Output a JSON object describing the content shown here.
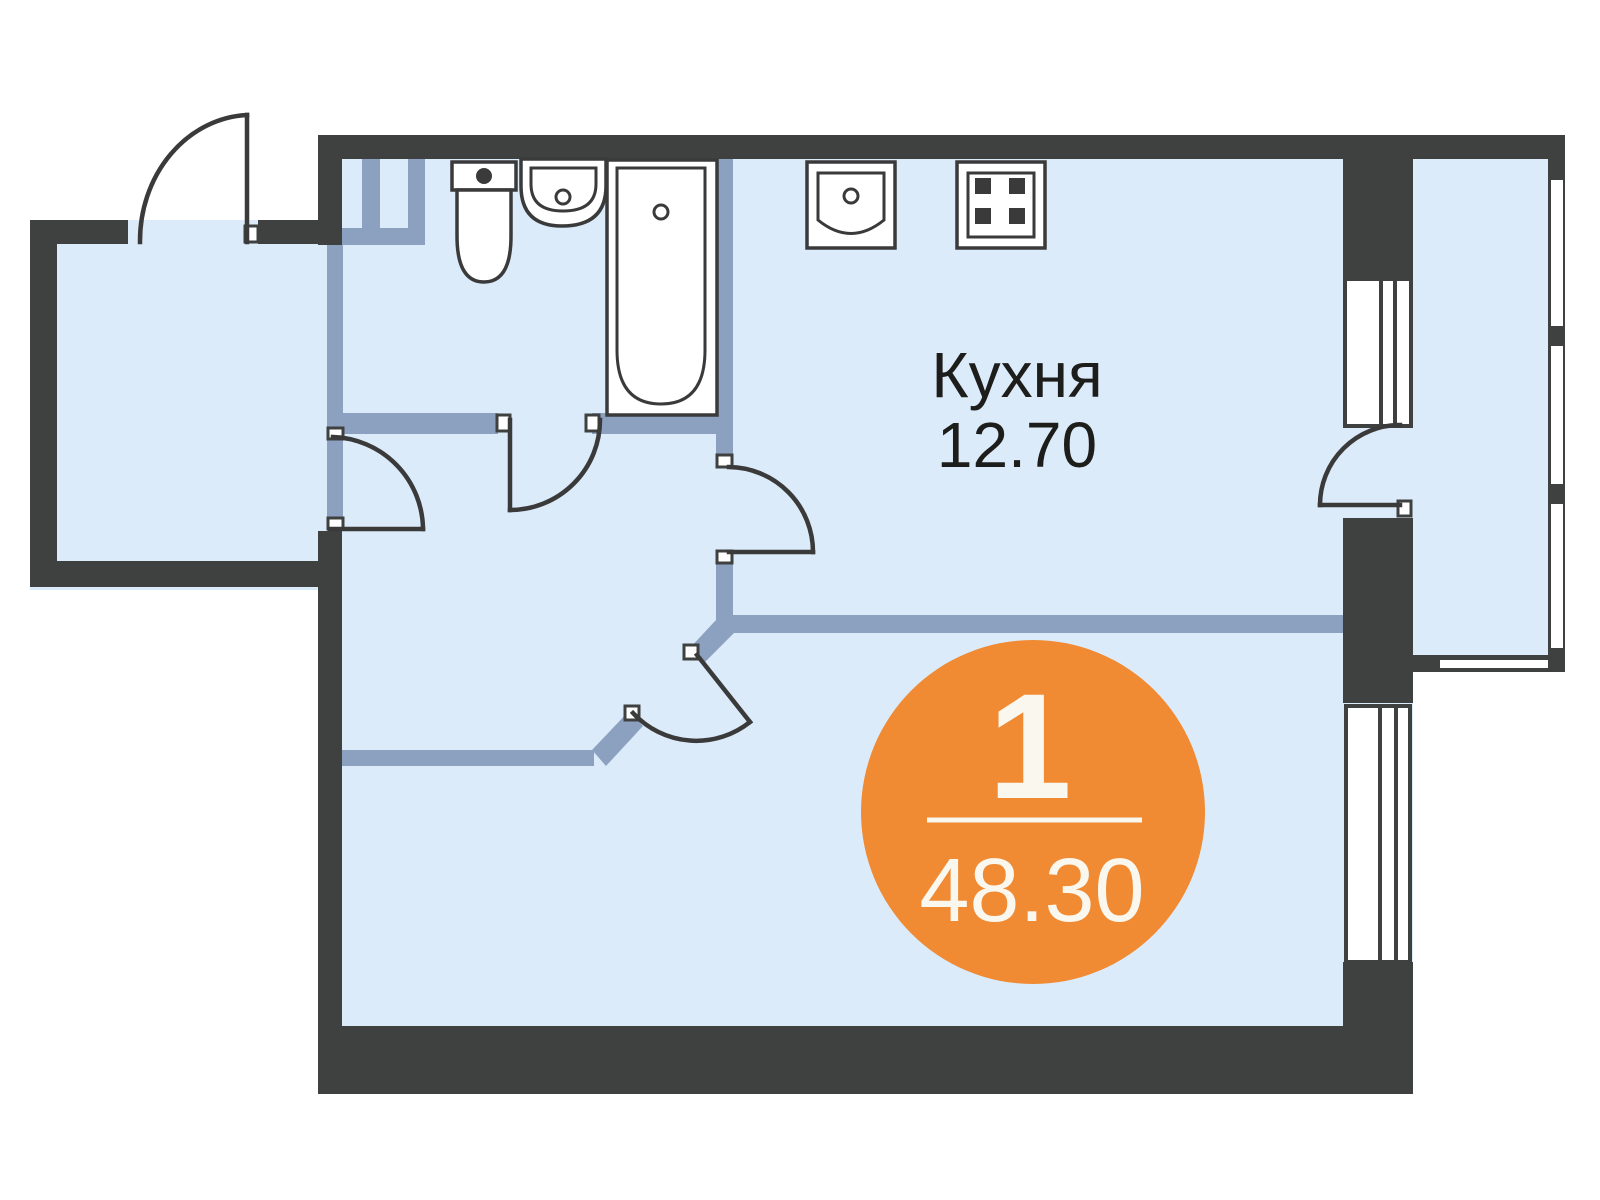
{
  "kitchen": {
    "label": "Кухня",
    "area": "12.70"
  },
  "badge": {
    "room_count": "1",
    "total_area": "48.30"
  },
  "colors": {
    "wall": "#3F4040",
    "partition": "#8BA1BF",
    "room_fill": "#DCEBFA",
    "outline": "#3A3A3A",
    "accent_orange": "#F08A33",
    "badge_text": "#FAF7EE",
    "label_text": "#1D1D1B"
  },
  "icons": [
    "toilet-icon",
    "bathroom-sink-icon",
    "bathtub-icon",
    "kitchen-sink-icon",
    "stove-icon",
    "door-swing-icon",
    "window-icon",
    "balcony-window-icon"
  ]
}
